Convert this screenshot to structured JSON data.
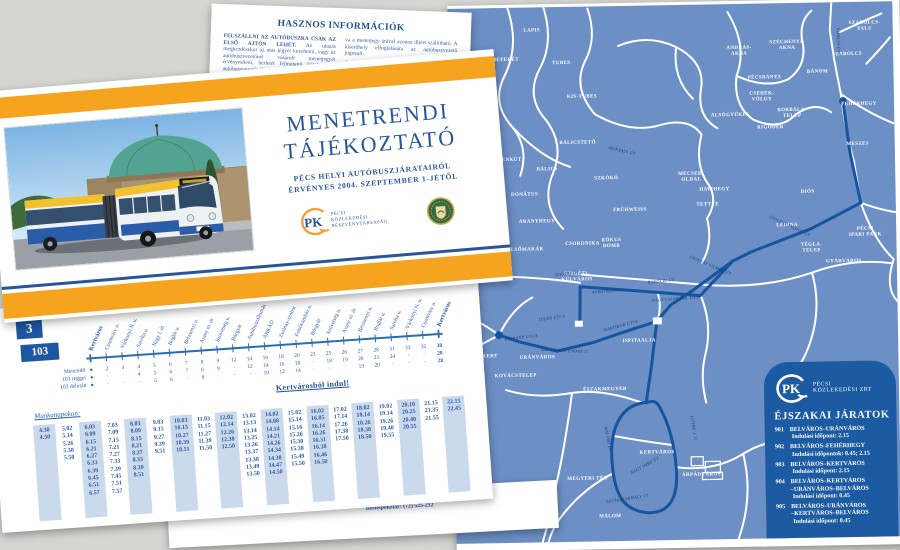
{
  "colors": {
    "accent_orange": "#f6a31f",
    "brand_blue": "#27549b",
    "map_blue": "#6c8fc5",
    "route_blue": "#17549e",
    "panel_blue": "#1c5aa2",
    "shade_blue": "#cbd9ec"
  },
  "info_sheet": {
    "heading": "HASZNOS INFORMÁCIÓK",
    "col1_bold": "FELSZÁLLNI AZ AUTÓBUSZRA CSAK AZ ELSŐ AJTÓN LEHET.",
    "col1_text": "Az utazás megkezdésekor az utas jegyét kezeltetni, vagy az autóbuszvezetőnél vásárolt menetjegyét érvényesíteni, bérletét felmutatni köteles. Az autóbuszvezetőnél lévő jegyek elővételben is megválthatók.",
    "col2_text1": "va a menetjegy árával azonos díjért szállítható. A kísérőhely elfoglalására az autóbuszvezető jogosult.",
    "col2_heading": "ÉLŐÁLLAT SZÁLLÍTÁSA",
    "col2_text2": "Az autóbuszon kis testű élőállat zárt szállítóeszközben, menetjeggyel szállítható. A kutya szájkosárral utazhat.",
    "footer_left": "meg nem haladó tárgy, megfelelően becsomagol-",
    "footer_right1": "Panasziroda: (72) 525-120",
    "footer_right2": "Bérletpénztár: (72) 525-212"
  },
  "cover": {
    "title1": "MENETRENDI",
    "title2": "TÁJÉKOZTATÓ",
    "sub1": "PÉCS HELYI AUTÓBUSZJÁRATAIRÓL",
    "sub2": "ÉRVÉNYES 2004. SZEPTEMBER 1-JÉTŐL",
    "logo": {
      "monogram": "PK",
      "l1": "PÉCSI",
      "l2": "KÖZLEKEDÉSI",
      "l3": "RÉSZVÉNYTÁRSASÁG"
    }
  },
  "timetable": {
    "route_short": "3",
    "route_long": "103",
    "legend": [
      "Menetidő",
      "103 reggel",
      "103 délután"
    ],
    "from_label": "Kertvárosból indul!",
    "workdays_label": "Munkanapokon:",
    "stops": [
      {
        "name": "Kertváros",
        "bold": true,
        "rows": [
          "●",
          "●",
          "●"
        ]
      },
      {
        "name": "Csontváry u.",
        "rows": [
          "2",
          "·",
          "·"
        ]
      },
      {
        "name": "Várkonyi N. u.",
        "rows": [
          "3",
          "·",
          "·"
        ]
      },
      {
        "name": "Sarolta u.",
        "rows": [
          "4",
          "4",
          "·"
        ]
      },
      {
        "name": "Nagy I. út",
        "rows": [
          "5",
          "5",
          "5"
        ]
      },
      {
        "name": "Boglár u.",
        "rows": [
          "6",
          "6",
          "6"
        ]
      },
      {
        "name": "Berzsenyi u.",
        "rows": [
          "7",
          "7",
          "·"
        ]
      },
      {
        "name": "Arany m. út",
        "rows": [
          "8",
          "8",
          "8"
        ]
      },
      {
        "name": "Szövetség u.",
        "rows": [
          "9",
          "9",
          "·"
        ]
      },
      {
        "name": "Bőrgyár",
        "rows": [
          "12",
          "·",
          "·"
        ]
      },
      {
        "name": "Autóbuszállomás",
        "rows": [
          "14",
          "12",
          "·"
        ]
      },
      {
        "name": "ÁRKÁD",
        "rows": [
          "16",
          "14",
          "10"
        ]
      },
      {
        "name": "Zsolnay-szobor",
        "rows": [
          "18",
          "16",
          "12"
        ]
      },
      {
        "name": "Felsővámház u.",
        "rows": [
          "20",
          "18",
          "14"
        ]
      },
      {
        "name": "Bőrgyár",
        "rows": [
          "23",
          "·",
          "·"
        ]
      },
      {
        "name": "Szövetség u.",
        "rows": [
          "25",
          "18",
          "·"
        ]
      },
      {
        "name": "Arany m. út",
        "rows": [
          "26",
          "19",
          "·"
        ]
      },
      {
        "name": "Berzsenyi u.",
        "rows": [
          "27",
          "20",
          "19"
        ]
      },
      {
        "name": "Boglár u.",
        "rows": [
          "28",
          "21",
          "20"
        ]
      },
      {
        "name": "Sarolta u.",
        "rows": [
          "31",
          "24",
          "·"
        ]
      },
      {
        "name": "Várkonyi N. u.",
        "rows": [
          "33",
          "·",
          "·"
        ]
      },
      {
        "name": "Csontváry u.",
        "rows": [
          "35",
          "·",
          "·"
        ]
      },
      {
        "name": "Kertváros",
        "bold": true,
        "rows": [
          "38",
          "28",
          "28"
        ]
      }
    ],
    "departures": [
      {
        "shaded": true,
        "times": [
          "4.30",
          "4.50"
        ]
      },
      {
        "shaded": false,
        "times": [
          "5.02",
          "5.14",
          "5.26",
          "5.38",
          "5.50"
        ]
      },
      {
        "shaded": true,
        "times": [
          "6.03",
          "6.09",
          "6.15",
          "6.21",
          "6.27",
          "6.33",
          "6.39",
          "6.45",
          "6.51",
          "6.57"
        ]
      },
      {
        "shaded": false,
        "times": [
          "7.03",
          "7.09",
          "7.15",
          "7.21",
          "7.27",
          "7.33",
          "7.39",
          "7.45",
          "7.51",
          "7.57"
        ]
      },
      {
        "shaded": true,
        "times": [
          "8.03",
          "8.09",
          "8.15",
          "8.21",
          "8.27",
          "8.33",
          "8.39",
          "8.51"
        ]
      },
      {
        "shaded": false,
        "times": [
          "9.03",
          "9.15",
          "9.27",
          "9.39",
          "9.51"
        ]
      },
      {
        "shaded": true,
        "times": [
          "10.03",
          "10.15",
          "10.27",
          "10.39",
          "10.51"
        ]
      },
      {
        "shaded": false,
        "times": [
          "11.03",
          "11.15",
          "11.27",
          "11.39",
          "11.50"
        ]
      },
      {
        "shaded": true,
        "times": [
          "12.02",
          "12.14",
          "12.26",
          "12.38",
          "12.50"
        ]
      },
      {
        "shaded": false,
        "times": [
          "13.02",
          "13.13",
          "13.14",
          "13.25",
          "13.26",
          "13.37",
          "13.38",
          "13.49",
          "13.50"
        ]
      },
      {
        "shaded": true,
        "times": [
          "14.02",
          "14.08",
          "14.14",
          "14.21",
          "14.26",
          "14.34",
          "14.38",
          "14.47",
          "14.50"
        ]
      },
      {
        "shaded": false,
        "times": [
          "15.02",
          "15.14",
          "15.16",
          "15.26",
          "15.30",
          "15.38",
          "15.49",
          "15.50"
        ]
      },
      {
        "shaded": true,
        "times": [
          "16.02",
          "16.05",
          "16.14",
          "16.26",
          "16.31",
          "16.38",
          "16.46",
          "16.50"
        ]
      },
      {
        "shaded": false,
        "times": [
          "17.02",
          "17.14",
          "17.26",
          "17.38",
          "17.50"
        ]
      },
      {
        "shaded": true,
        "times": [
          "18.02",
          "18.14",
          "18.26",
          "18.38",
          "18.50"
        ]
      },
      {
        "shaded": false,
        "times": [
          "19.02",
          "19.14",
          "19.26",
          "19.40",
          "19.55"
        ]
      },
      {
        "shaded": true,
        "times": [
          "20.10",
          "20.25",
          "20.40",
          "20.55"
        ]
      },
      {
        "shaded": false,
        "times": [
          "21.15",
          "21.35",
          "21.55"
        ]
      },
      {
        "shaded": true,
        "times": [
          "22.15",
          "22.45"
        ]
      }
    ]
  },
  "night_panel": {
    "logo": {
      "monogram": "PK",
      "l1": "PÉCSI",
      "l2": "KÖZLEKEDÉSI ZRT"
    },
    "title": "ÉJSZAKAI JÁRATOK",
    "routes": [
      {
        "num": "901",
        "name": "BELVÁROS–URÁNVÁROS",
        "departure": "Indulási időpont: 2.15"
      },
      {
        "num": "902",
        "name": "BELVÁROS–FEHÉRHEGY",
        "departure": "Indulási időpontok: 0.45; 2.15"
      },
      {
        "num": "903",
        "name": "BELVÁROS–KERTVÁROS",
        "departure": "Indulási időpont: 2.15"
      },
      {
        "num": "904",
        "name": "BELVÁROS–KERTVÁROS\n–URÁNVÁROS–BELVÁROS",
        "departure": "Indulási időpont: 0.45"
      },
      {
        "num": "905",
        "name": "BELVÁROS–URÁNVÁROS\n–KERTVÁROS–BELVÁROS",
        "departure": "Indulási időpont: 0.45"
      }
    ]
  },
  "map": {
    "area_labels": [
      {
        "t": "REMETERÉT",
        "x": 53,
        "y": 53
      },
      {
        "t": "LAPIS",
        "x": 84,
        "y": 24
      },
      {
        "t": "TUBES",
        "x": 113,
        "y": 57
      },
      {
        "t": "KIS-TUBES",
        "x": 133,
        "y": 91
      },
      {
        "t": "ISTENKÚT",
        "x": 57,
        "y": 153
      },
      {
        "t": "BÁLICS",
        "x": 97,
        "y": 163
      },
      {
        "t": "BÁLICSTETŐ",
        "x": 128,
        "y": 137
      },
      {
        "t": "SZKÓKÓ",
        "x": 156,
        "y": 173
      },
      {
        "t": "DONÁTUS",
        "x": 74,
        "y": 188
      },
      {
        "t": "ARANYHEGY",
        "x": 86,
        "y": 215
      },
      {
        "t": "FRÜHWEISS",
        "x": 179,
        "y": 205
      },
      {
        "t": "FELSŐMAKÁR",
        "x": 72,
        "y": 243
      },
      {
        "t": "CSORONIKA",
        "x": 131,
        "y": 238
      },
      {
        "t": "RÓKUS\nDOMB",
        "x": 160,
        "y": 235
      },
      {
        "t": "MECSEK-\nOLDAL",
        "x": 241,
        "y": 170
      },
      {
        "t": "ANDRÁS-\nAKNA",
        "x": 291,
        "y": 45
      },
      {
        "t": "SZÉCHENYI-\nAKNA",
        "x": 339,
        "y": 40
      },
      {
        "t": "SZABOLCS-\nFALU",
        "x": 417,
        "y": 22
      },
      {
        "t": "SZABOLCS",
        "x": 399,
        "y": 53
      },
      {
        "t": "BÁNOM",
        "x": 369,
        "y": 70
      },
      {
        "t": "PÉCSBÁNYA",
        "x": 316,
        "y": 75
      },
      {
        "t": "CSERÉK-\nVÖLGY",
        "x": 313,
        "y": 91
      },
      {
        "t": "ALSÓGYÜKÉS",
        "x": 281,
        "y": 112
      },
      {
        "t": "BORBÁLA-\nTELEP",
        "x": 343,
        "y": 108
      },
      {
        "t": "RIGÓDER",
        "x": 321,
        "y": 125
      },
      {
        "t": "FEHÉRHEGY",
        "x": 410,
        "y": 103
      },
      {
        "t": "MESZES",
        "x": 408,
        "y": 143
      },
      {
        "t": "HAVIHEGY",
        "x": 264,
        "y": 186
      },
      {
        "t": "TETTYE",
        "x": 257,
        "y": 201
      },
      {
        "t": "DIÓS",
        "x": 357,
        "y": 190
      },
      {
        "t": "LEDINA",
        "x": 336,
        "y": 223
      },
      {
        "t": "TÉGLA-\nTELEP",
        "x": 360,
        "y": 243
      },
      {
        "t": "PÉCSI\nIPARI PARK",
        "x": 414,
        "y": 228
      },
      {
        "t": "GYÁRVÁROS",
        "x": 392,
        "y": 260
      },
      {
        "t": "SZIGETI-\nKÜLVÁROS",
        "x": 125,
        "y": 268
      },
      {
        "t": "ISPITAALJA",
        "x": 186,
        "y": 336
      },
      {
        "t": "URÁNVÁROS",
        "x": 84,
        "y": 351
      },
      {
        "t": "KOVÁCSTELEP",
        "x": 62,
        "y": 369
      },
      {
        "t": "CSILLAGKERT",
        "x": 24,
        "y": 349
      },
      {
        "t": "ÉSZAKMEGYER",
        "x": 151,
        "y": 384
      },
      {
        "t": "KERTVÁROS",
        "x": 202,
        "y": 448
      },
      {
        "t": "ÁRPÁDVÁROS",
        "x": 246,
        "y": 471
      },
      {
        "t": "MÁLOM",
        "x": 154,
        "y": 511
      },
      {
        "t": "MEGYERI TÉR",
        "x": 132,
        "y": 473
      }
    ],
    "road_labels": [
      {
        "t": "KOMLÓI ÚT",
        "x": 389,
        "y": 38,
        "r": 90
      },
      {
        "t": "HUNYADI ÚT",
        "x": 172,
        "y": 146,
        "r": 14
      },
      {
        "t": "ZSOLNAY VILMOS ÚT",
        "x": 338,
        "y": 224,
        "r": 26
      },
      {
        "t": "ZSOLNAY VILMOS ÚT",
        "x": 258,
        "y": 262,
        "r": 24
      },
      {
        "t": "RÁKÓCZI ÚT",
        "x": 209,
        "y": 277,
        "r": -4
      },
      {
        "t": "ALKOTMÁNY U.",
        "x": 156,
        "y": 286,
        "r": -3
      },
      {
        "t": "NAGY LAJOS KIR. ÚTJA",
        "x": 224,
        "y": 295,
        "r": -3
      },
      {
        "t": "SZIGETI ÚT",
        "x": 115,
        "y": 268,
        "r": -5
      },
      {
        "t": "TÜZÉR UTCA",
        "x": 99,
        "y": 312,
        "r": -8
      },
      {
        "t": "PÁFRÁNY UTCA",
        "x": 68,
        "y": 331,
        "r": -6
      },
      {
        "t": "DR. VERESS ENDRE U.",
        "x": 112,
        "y": 345,
        "r": 4
      },
      {
        "t": "MÁRTÍROK ÚTJA",
        "x": 168,
        "y": 321,
        "r": -14
      },
      {
        "t": "NAGY IMRE ÚT",
        "x": 190,
        "y": 461,
        "r": -28
      },
      {
        "t": "MÁLOMI ÚT",
        "x": 152,
        "y": 433,
        "r": 80
      },
      {
        "t": "SZTÁRAI MIHÁLY ÚT",
        "x": 172,
        "y": 494,
        "r": -8
      },
      {
        "t": "LITTKE J. U.",
        "x": 238,
        "y": 424,
        "r": 82
      }
    ]
  }
}
